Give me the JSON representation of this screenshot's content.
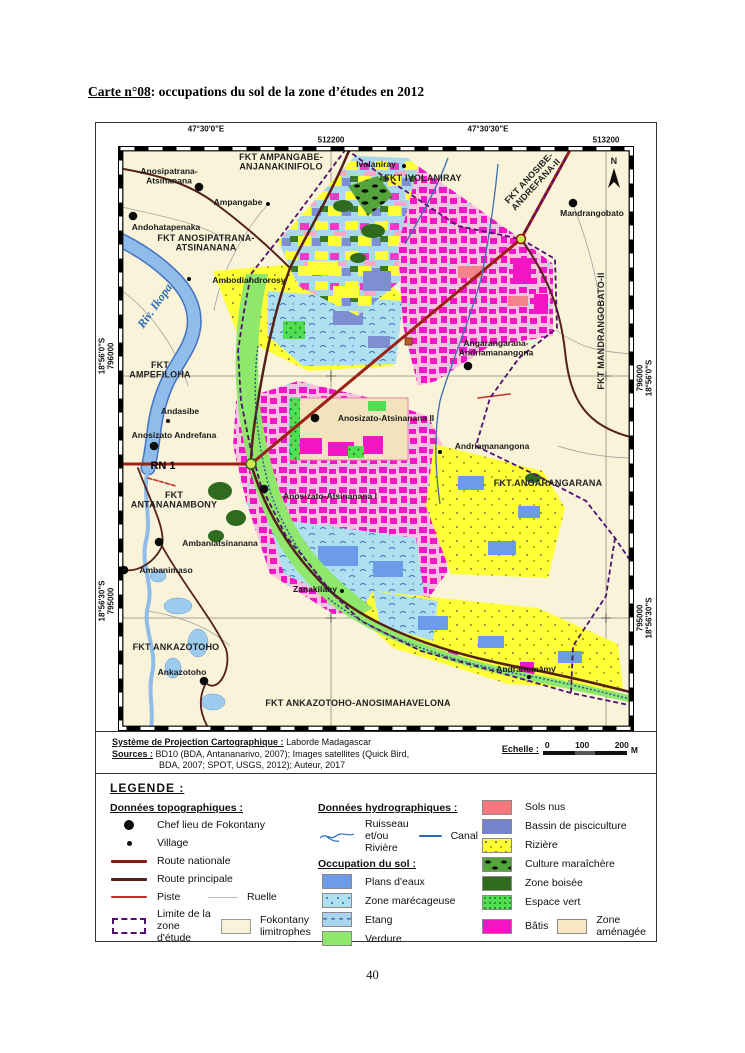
{
  "page": {
    "title_prefix": "Carte n°08",
    "title_suffix": ": occupations du sol de la zone d’études en 2012",
    "page_number": "40"
  },
  "colors": {
    "batis": "#F316C6",
    "riziere": "#FFFF37",
    "plans_deaux": "#6C9BE8",
    "verdure": "#8FE76B",
    "route_nationale": "#8B1A10",
    "limite_zone": "#51106E",
    "fond_carte": "#F8F3D9"
  },
  "map": {
    "grid": {
      "lon_w": "47°30'0\"E",
      "lon_e": "47°30'30\"E",
      "easting_w": "512200",
      "easting_e": "513200",
      "lat_n": "18°56'0\"S",
      "lat_s": "18°56'30\"S",
      "northing_n": "796000",
      "northing_s": "795000"
    },
    "north_label": "N",
    "labels": [
      {
        "t": "Anosipatrana-\nAtsinanana",
        "x": 51,
        "y": 28,
        "s": "place"
      },
      {
        "t": "FKT AMPANGABE-\nANJANAKINIFOLO",
        "x": 163,
        "y": 14,
        "s": "fkt"
      },
      {
        "t": "Ivolaniray",
        "x": 258,
        "y": 21,
        "s": "place"
      },
      {
        "t": "FKT IVOLANIRAY",
        "x": 305,
        "y": 35,
        "s": "fkt"
      },
      {
        "t": "FKT ANOSIBE-\nANDREFANA-II",
        "x": 413,
        "y": 34,
        "r": -47,
        "s": "fkt"
      },
      {
        "t": "Ampangabe",
        "x": 120,
        "y": 59,
        "s": "place"
      },
      {
        "t": "Mandrangobato",
        "x": 474,
        "y": 70,
        "s": "place"
      },
      {
        "t": "Andohatapenaka",
        "x": 48,
        "y": 84,
        "s": "place"
      },
      {
        "t": "FKT ANOSIPATRANA-\nATSINANANA",
        "x": 88,
        "y": 95,
        "s": "fkt"
      },
      {
        "t": "Ambodiandrorosy",
        "x": 131,
        "y": 137,
        "s": "place"
      },
      {
        "t": "Riv. Ikopa",
        "x": 40,
        "y": 162,
        "r": -55,
        "s": "river"
      },
      {
        "t": "FKT MANDRANGOBATO-II",
        "x": 486,
        "y": 185,
        "r": -90,
        "s": "fkt"
      },
      {
        "t": "FKT\nAMPEFILOHA",
        "x": 42,
        "y": 222,
        "s": "fkt"
      },
      {
        "t": "Angarangarana-\nAndriamanangona",
        "x": 378,
        "y": 200,
        "s": "place"
      },
      {
        "t": "Andasibe",
        "x": 62,
        "y": 268,
        "s": "place"
      },
      {
        "t": "Anosizato-Atsinanana II",
        "x": 268,
        "y": 275,
        "s": "place"
      },
      {
        "t": "Anosizato Andrefana",
        "x": 56,
        "y": 292,
        "s": "place"
      },
      {
        "t": "Andriamanangona",
        "x": 374,
        "y": 303,
        "s": "place"
      },
      {
        "t": "RN 1",
        "x": 45,
        "y": 323,
        "s": "rn"
      },
      {
        "t": "FKT ANGARANGARANA",
        "x": 430,
        "y": 340,
        "s": "fkt"
      },
      {
        "t": "Anosizato-Atsinanana I",
        "x": 212,
        "y": 353,
        "s": "place"
      },
      {
        "t": "FKT\nANTANANAMBONY",
        "x": 56,
        "y": 352,
        "s": "fkt"
      },
      {
        "t": "Ambaniatsinanana",
        "x": 102,
        "y": 400,
        "s": "place"
      },
      {
        "t": "Ambanimaso",
        "x": 48,
        "y": 427,
        "s": "place"
      },
      {
        "t": "Zanakilahy",
        "x": 197,
        "y": 446,
        "s": "place"
      },
      {
        "t": "FKT ANKAZOTOHO",
        "x": 58,
        "y": 504,
        "s": "fkt"
      },
      {
        "t": "Ankazotoho",
        "x": 64,
        "y": 529,
        "s": "place"
      },
      {
        "t": "Andranomamy",
        "x": 408,
        "y": 526,
        "s": "place"
      },
      {
        "t": "FKT ANKAZOTOHO-ANOSIMAHAVELONA",
        "x": 240,
        "y": 560,
        "s": "fkt"
      },
      {
        "t": "N",
        "x": 496,
        "y": 18,
        "s": "fkt"
      }
    ],
    "chef_lieu_points": [
      [
        81,
        41
      ],
      [
        15,
        70
      ],
      [
        455,
        57
      ],
      [
        350,
        220
      ],
      [
        197,
        272
      ],
      [
        36,
        300
      ],
      [
        146,
        343
      ],
      [
        41,
        396
      ],
      [
        6,
        424
      ],
      [
        86,
        535
      ]
    ],
    "village_points": [
      [
        286,
        20
      ],
      [
        150,
        58
      ],
      [
        71,
        133
      ],
      [
        50,
        275
      ],
      [
        322,
        306
      ],
      [
        224,
        445
      ],
      [
        411,
        531
      ]
    ]
  },
  "footer": {
    "projection_label": "Système de Projection Cartographique :",
    "projection_value": "Laborde Madagascar",
    "sources_label": "Sources :",
    "sources_value1": "BD10 (BDA, Antananarivo, 2007); Images satellites (Quick Bird,",
    "sources_value2": "BDA, 2007; SPOT, USGS, 2012); Auteur, 2017",
    "scale_label": "Echelle :",
    "scale_t0": "0",
    "scale_t1": "100",
    "scale_t2": "200",
    "scale_unit": "M"
  },
  "legend": {
    "title": "LEGENDE :",
    "topo": {
      "title": "Données topographiques :",
      "chef_lieu": "Chef lieu de  Fokontany",
      "village": "Village",
      "route_nationale": "Route nationale",
      "route_principale": "Route principale",
      "piste": "Piste",
      "ruelle": "Ruelle",
      "limite": "Limite de la zone d'étude",
      "fokontany": "Fokontany limitrophes"
    },
    "hydro": {
      "title": "Données hydrographiques :",
      "ruisseau": "Ruisseau et/ou Rivière",
      "canal": "Canal"
    },
    "landuse": {
      "title": "Occupation du sol :",
      "plans_deaux": "Plans d'eaux",
      "marecageuse": "Zone marécageuse",
      "etang": "Etang",
      "verdure": "Verdure",
      "sols_nus": "Sols nus",
      "bassin": "Bassin de pisciculture",
      "riziere": "Rizière",
      "culture": "Culture maraîchère",
      "boisee": "Zone boisée",
      "espace_vert": "Espace vert",
      "batis": "Bâtis",
      "amenagee": "Zone aménagée"
    }
  }
}
